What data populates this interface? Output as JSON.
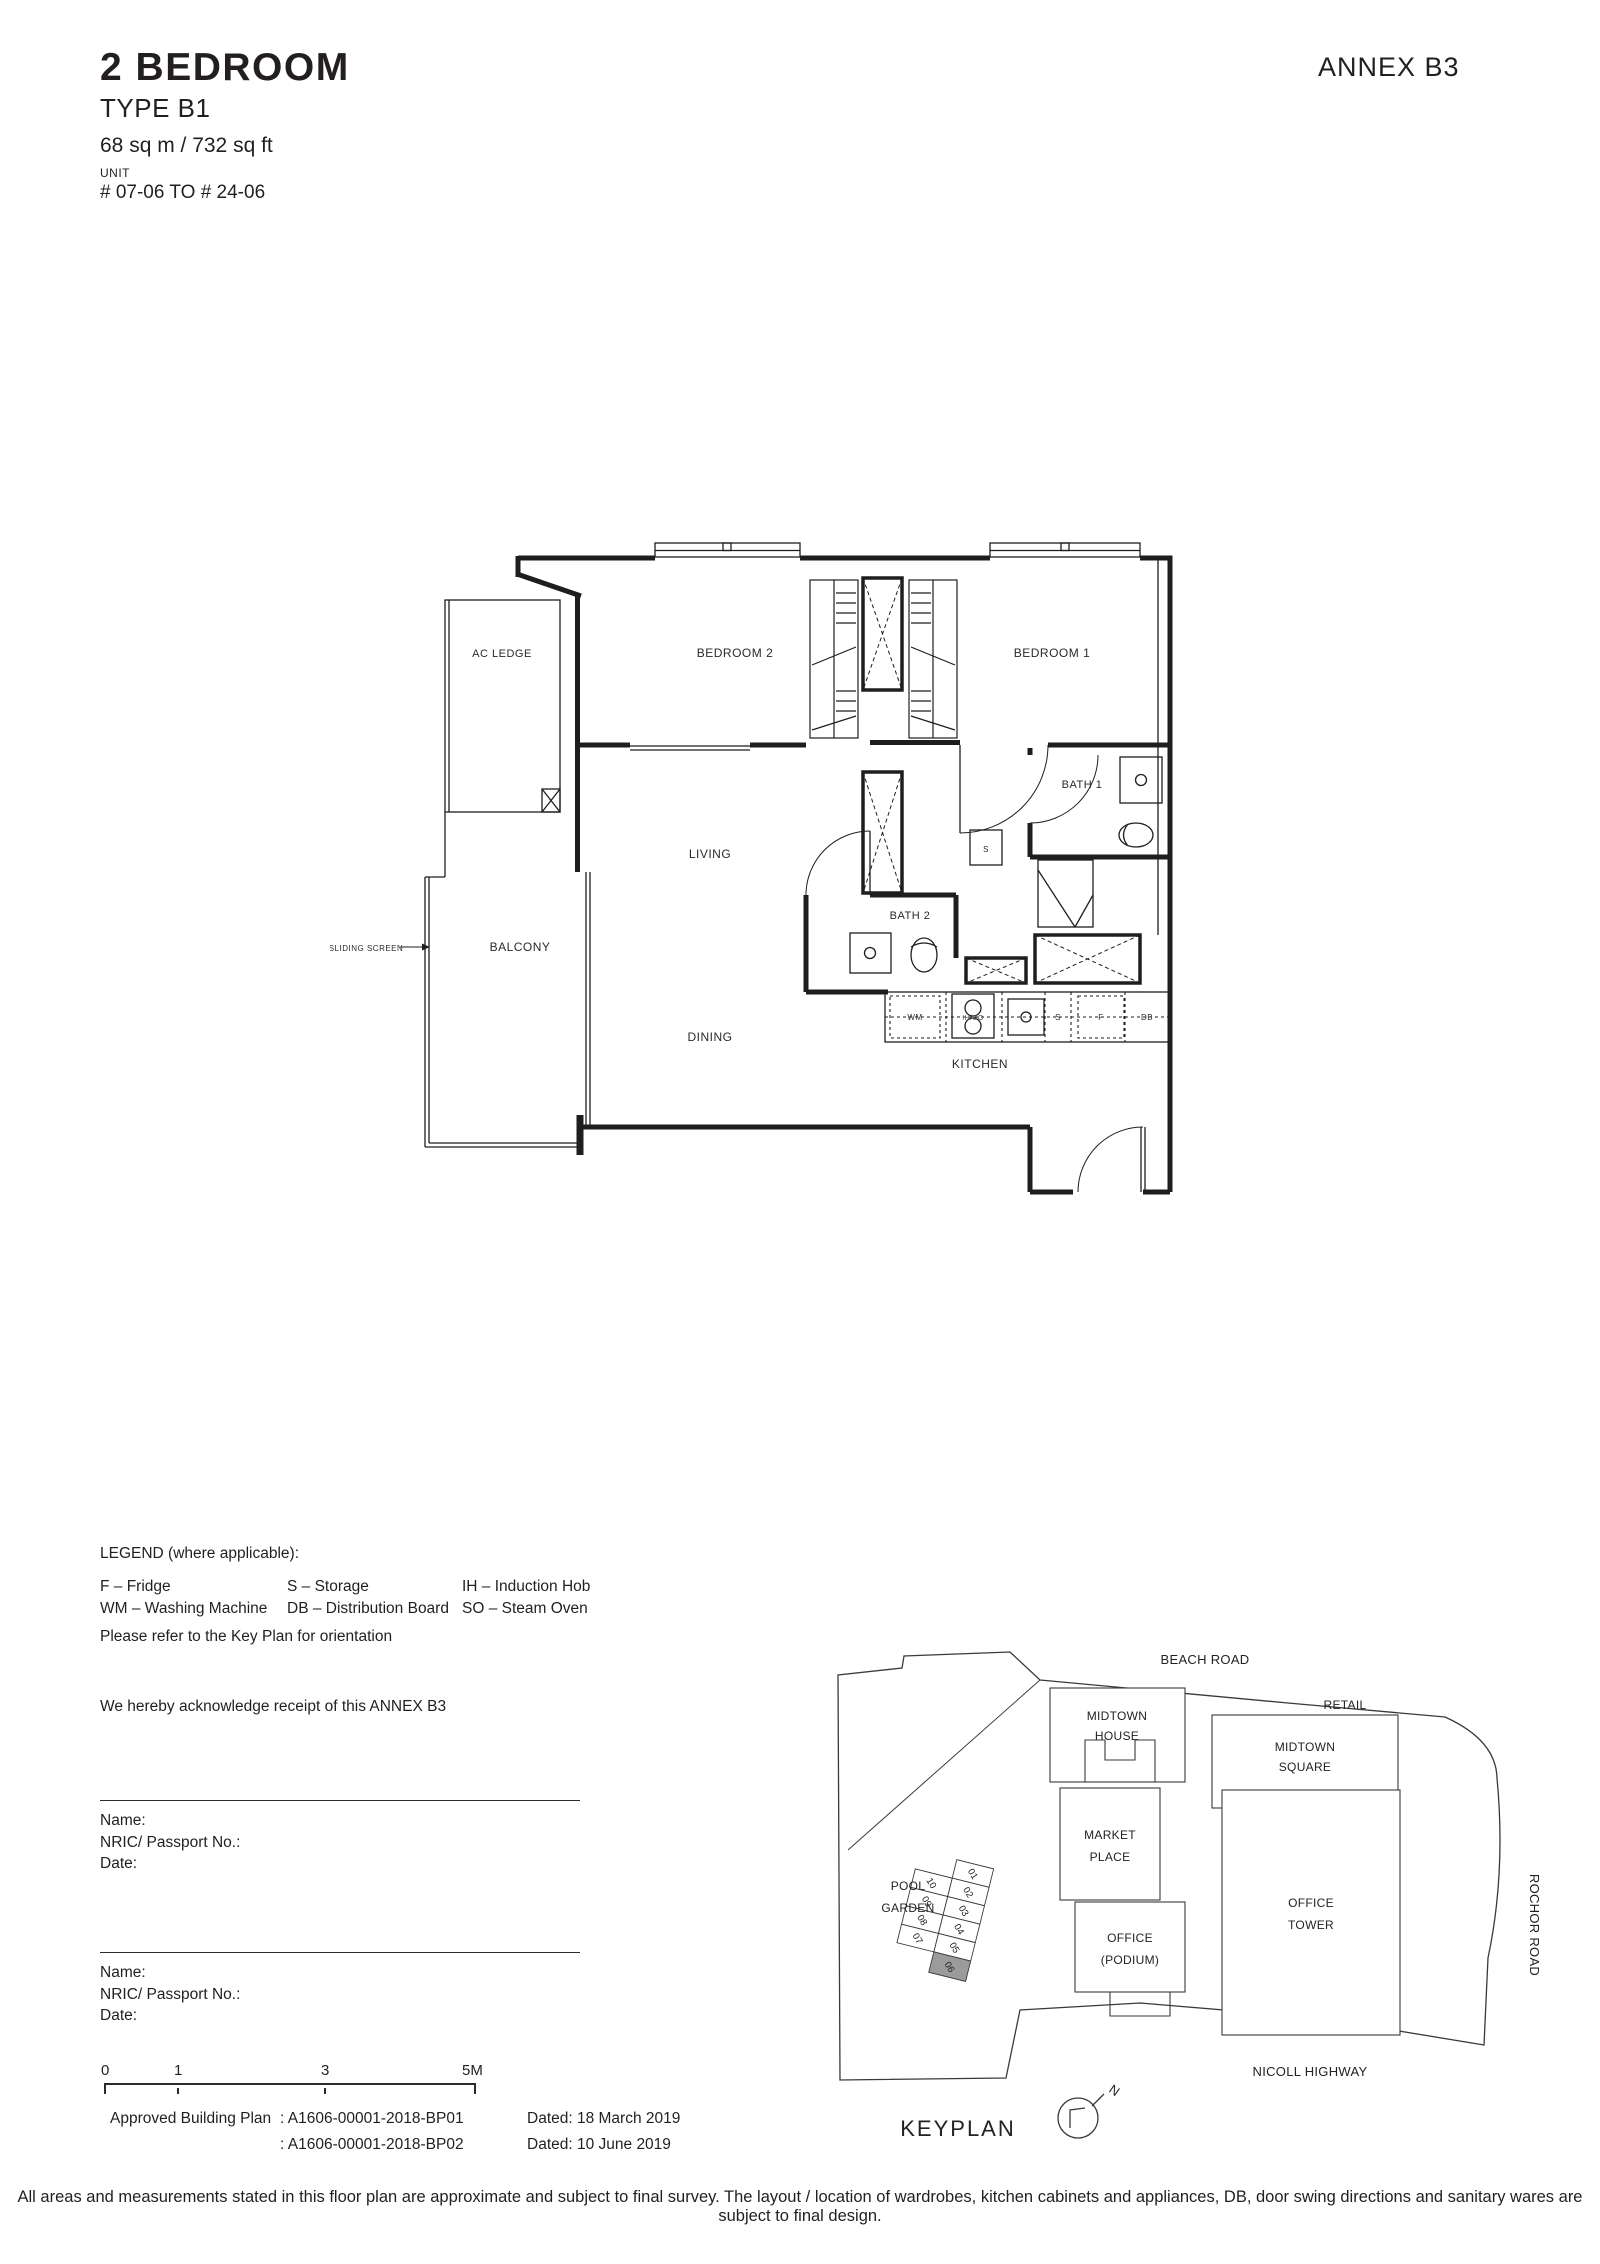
{
  "header": {
    "title": "2 BEDROOM",
    "subtitle": "TYPE B1",
    "area": "68 sq m / 732 sq ft",
    "unit_label": "UNIT",
    "unit_range": "# 07-06 TO # 24-06",
    "annex": "ANNEX B3"
  },
  "floorplan": {
    "rooms": {
      "ac_ledge": "AC LEDGE",
      "bedroom_2": "BEDROOM 2",
      "bedroom_1": "BEDROOM 1",
      "bath_1": "BATH 1",
      "bath_2": "BATH 2",
      "living": "LIVING",
      "dining": "DINING",
      "balcony": "BALCONY",
      "kitchen": "KITCHEN"
    },
    "annotations": {
      "sliding_screen": "SLIDING SCREEN"
    },
    "fixtures": {
      "wm": "WM",
      "hob": "IH/SO",
      "storage": "S",
      "storage_room": "S",
      "fridge": "F",
      "db": "DB"
    }
  },
  "legend": {
    "title": "LEGEND (where applicable):",
    "items": [
      "F – Fridge",
      "WM – Washing Machine",
      "S – Storage",
      "DB – Distribution Board",
      "IH – Induction Hob",
      "SO – Steam Oven"
    ],
    "orientation_note": "Please refer to the Key Plan for orientation",
    "acknowledgement": "We hereby acknowledge receipt of this ANNEX B3"
  },
  "signatures": [
    {
      "name_label": "Name:",
      "nric_label": "NRIC/ Passport No.:",
      "date_label": "Date:"
    },
    {
      "name_label": "Name:",
      "nric_label": "NRIC/ Passport No.:",
      "date_label": "Date:"
    }
  ],
  "scale_bar": {
    "ticks": [
      "0",
      "1",
      "3",
      "5M"
    ]
  },
  "approval": {
    "label": "Approved Building Plan",
    "plans": [
      {
        "no": ": A1606-00001-2018-BP01",
        "dated": "Dated: 18 March 2019"
      },
      {
        "no": ": A1606-00001-2018-BP02",
        "dated": "Dated: 10 June 2019"
      }
    ]
  },
  "keyplan": {
    "title": "KEYPLAN",
    "north_label": "N",
    "roads": {
      "beach_road": "BEACH ROAD",
      "nicoll_highway": "NICOLL HIGHWAY",
      "rochor_road": "ROCHOR ROAD"
    },
    "buildings": {
      "midtown_house": [
        "MIDTOWN",
        "HOUSE"
      ],
      "retail": "RETAIL",
      "midtown_square": [
        "MIDTOWN",
        "SQUARE"
      ],
      "market_place": [
        "MARKET",
        "PLACE"
      ],
      "office_tower": [
        "OFFICE",
        "TOWER"
      ],
      "office_podium": [
        "OFFICE",
        "(PODIUM)"
      ],
      "pool_garden": [
        "POOL",
        "GARDEN"
      ]
    },
    "units": [
      "01",
      "02",
      "03",
      "04",
      "05",
      "06",
      "07",
      "08",
      "09",
      "10"
    ],
    "highlighted_unit": "06",
    "highlight_color": "#9b9b9b"
  },
  "disclaimer": "All areas and measurements stated in this floor plan are approximate and subject to final survey. The layout / location of wardrobes, kitchen cabinets and appliances, DB, door swing directions and sanitary wares are subject to final design.",
  "colors": {
    "line": "#1e1e1e",
    "text": "#231f20",
    "highlight": "#9b9b9b"
  }
}
